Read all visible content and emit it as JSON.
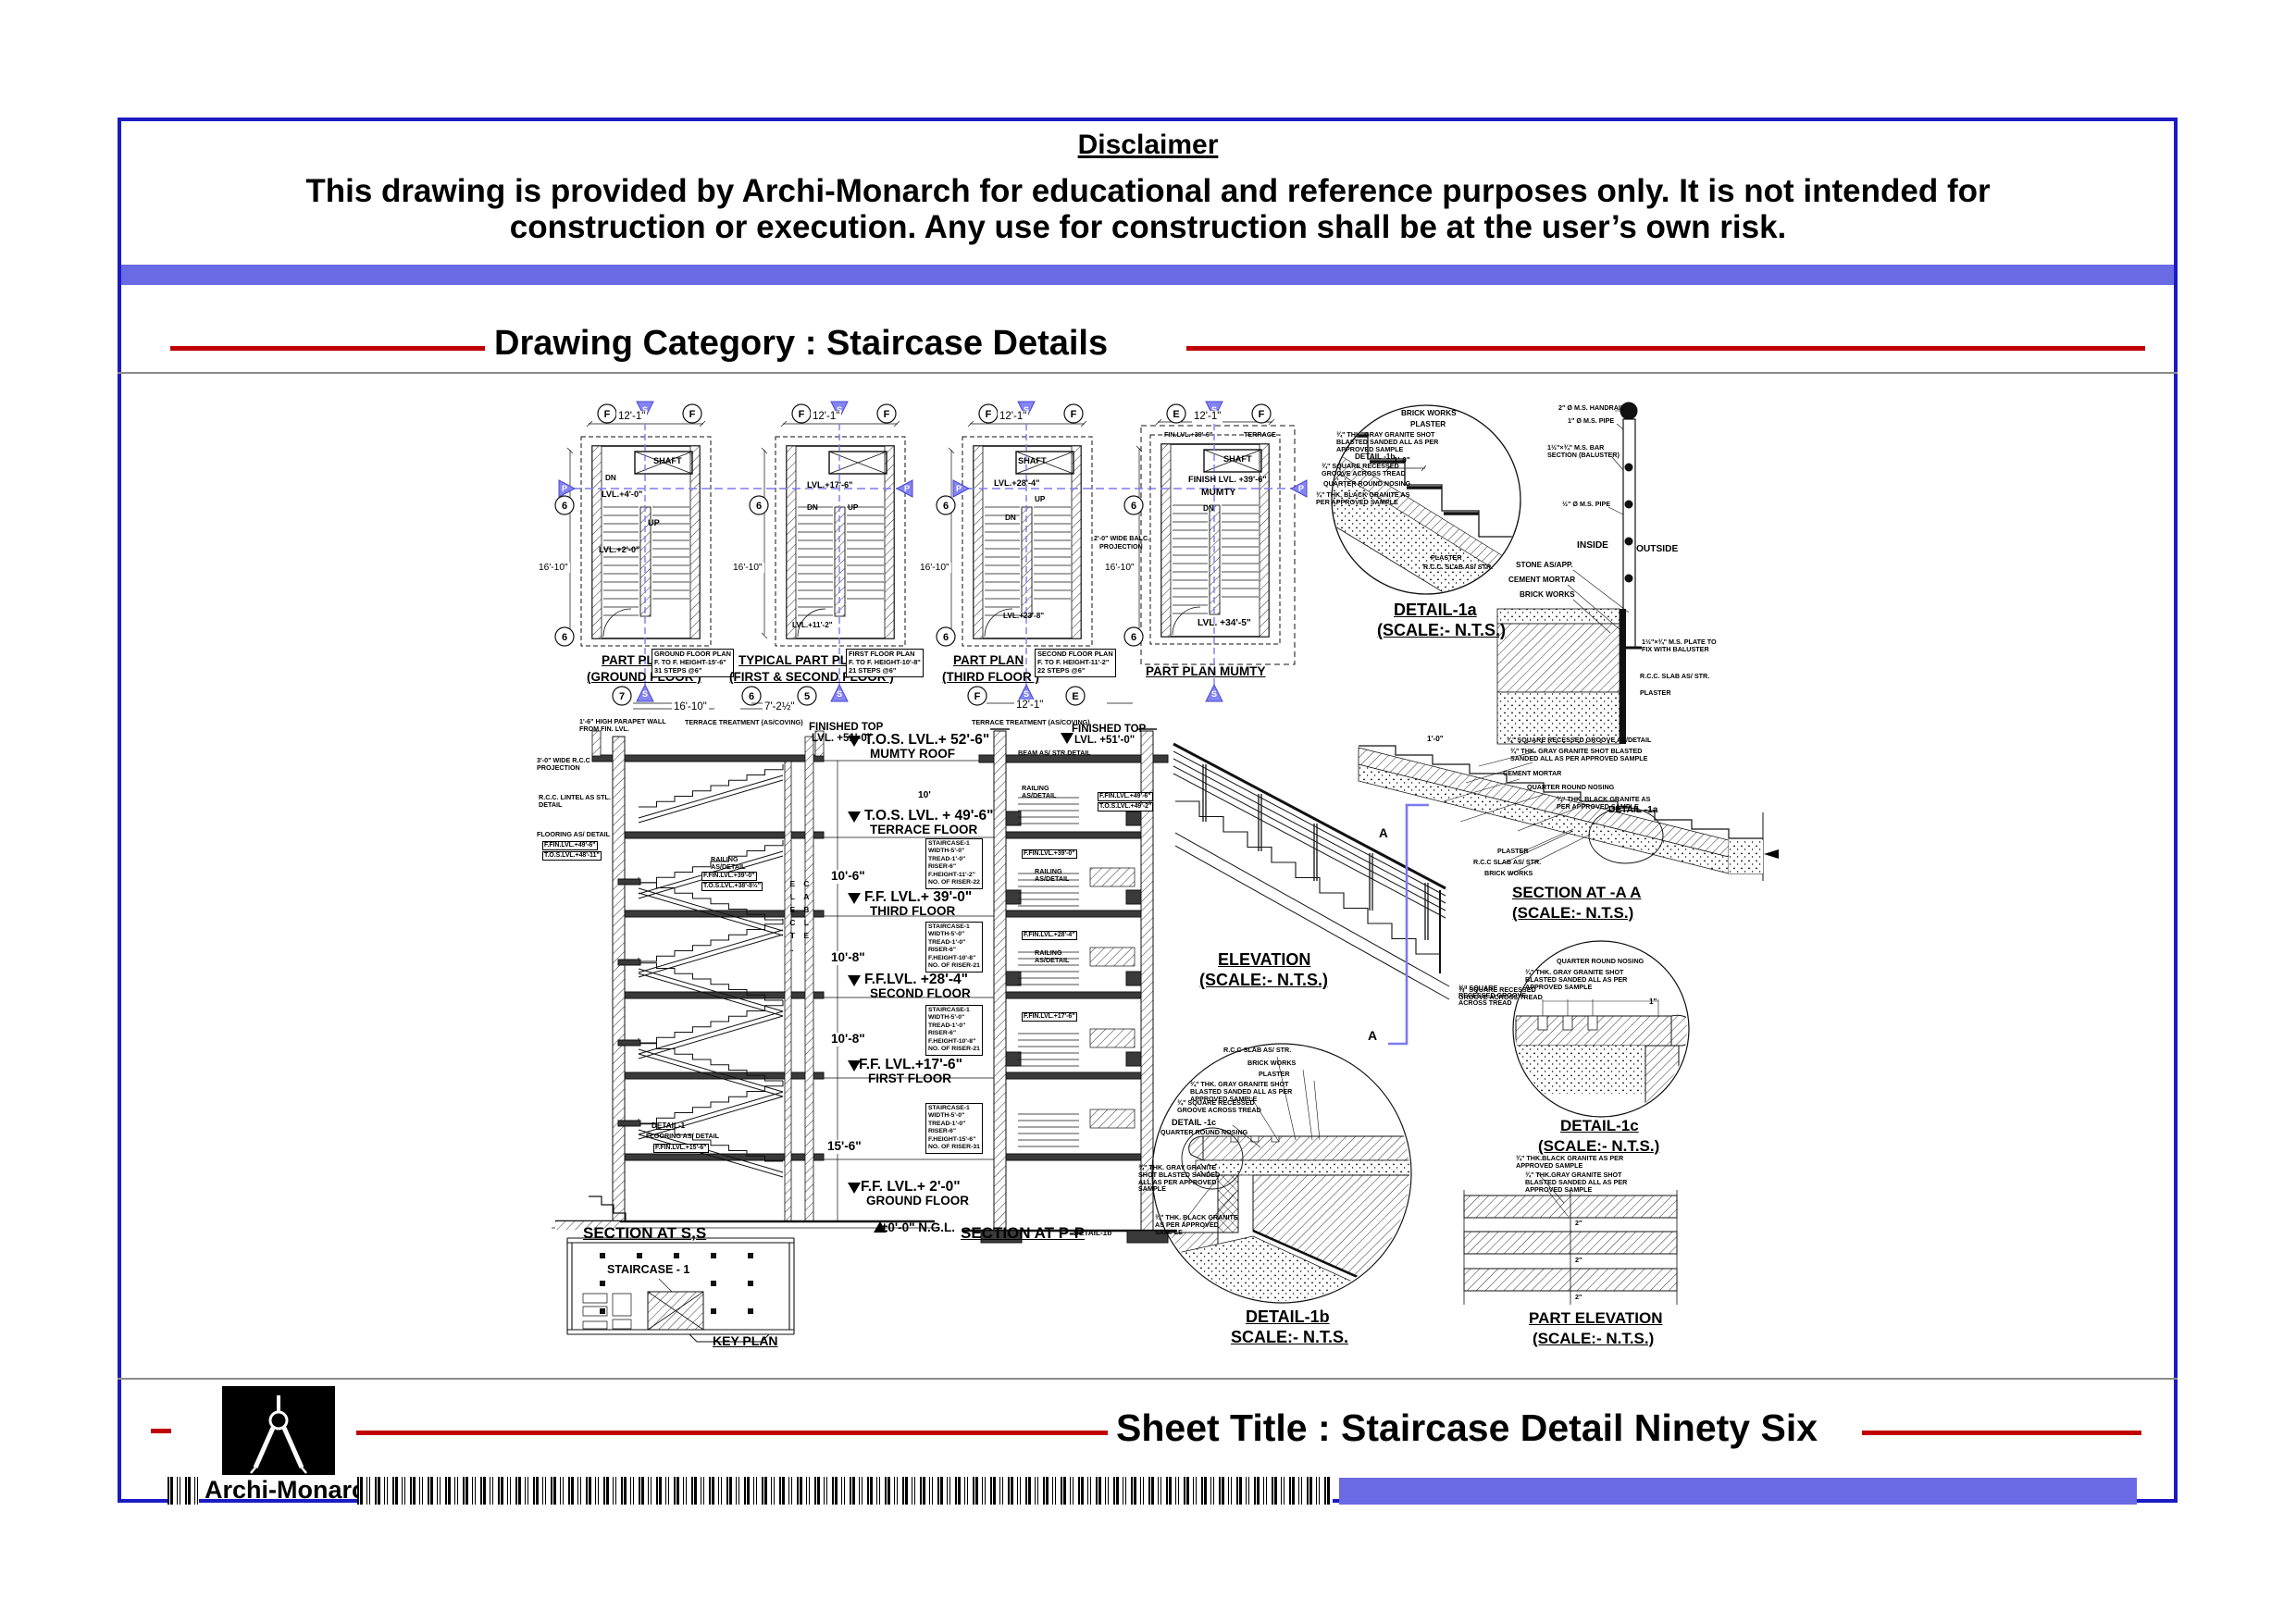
{
  "disclaimer": {
    "title": "Disclaimer",
    "line1": "This drawing is provided by Archi-Monarch for educational and reference purposes only. It is not intended for",
    "line2": "construction or execution. Any use for construction shall be at the user’s own risk."
  },
  "category": {
    "label": "Drawing Category : Staircase Details"
  },
  "footer": {
    "sheet_title": "Sheet Title : Staircase Detail Ninety Six",
    "brand": "Archi-Monarch"
  },
  "colors": {
    "frame_blue": "#1b1bc4",
    "band_blue": "#6a6ae4",
    "accent_red": "#c00000",
    "marker_blue": "#7b7bf0"
  },
  "plans": [
    {
      "title1": "PART PLAN",
      "title2": "(GROUND FLOOR )",
      "dim_w": "12'-1\"",
      "dim_h": "16'-10\"",
      "note1": "GROUND FLOOR PLAN",
      "note2": "F. TO F. HEIGHT-15'-6\"",
      "note3": "31 STEPS @6\"",
      "shaft": "SHAFT",
      "dn": "DN",
      "up": "UP",
      "lvl_a": "LVL.+4'-0\"",
      "lvl_b": "LVL.+2'-0\"",
      "b_t1": "F",
      "b_t2": "F",
      "b_s1": "6",
      "b_s2": "6",
      "b_b1": "7",
      "marker_s": "S",
      "marker_p": "P"
    },
    {
      "title1": "TYPICAL PART PLAN",
      "title2": "(FIRST & SECOND FLOOR )",
      "dim_w": "12'-1\"",
      "dim_h": "16'-10\"",
      "note1": "FIRST FLOOR PLAN",
      "note2": "F. TO F. HEIGHT-10'-8\"",
      "note3": "21 STEPS @6\"",
      "dn": "DN",
      "up": "UP",
      "lvl_a": "LVL.+17'-6\"",
      "lvl_b": "LVL.+11'-2\"",
      "b_t1": "F",
      "b_t2": "F",
      "b_s1": "6",
      "b_b1": "6",
      "b_b2": "5",
      "marker_s": "S",
      "marker_p": "P"
    },
    {
      "title1": "PART PLAN",
      "title2": "(THIRD  FLOOR )",
      "dim_w": "12'-1\"",
      "dim_h": "16'-10\"",
      "note1": "SECOND FLOOR PLAN",
      "note2": "F. TO F. HEIGHT-11'-2\"",
      "note3": "22 STEPS @6\"",
      "shaft": "SHAFT",
      "dn": "DN",
      "up": "UP",
      "lvl_a": "LVL.+28'-4\"",
      "lvl_b": "LVL.+23'-8\"",
      "b_t1": "F",
      "b_t2": "F",
      "b_s1": "6",
      "b_s2": "6",
      "b_b1": "F",
      "b_b2": "E",
      "marker_s": "S",
      "marker_p": "P"
    },
    {
      "title1": "PART PLAN MUMTY",
      "dim_w": "12'-1\"",
      "dim_h": "16'-10\"",
      "terrace": "TERRACE",
      "fin_top": "FIN.LVL.+39'-6\"",
      "shaft": "SHAFT",
      "finish": "FINISH LVL. +39'-6\"",
      "mumty": "MUMTY",
      "dn": "DN",
      "balc1": "2'-0\" WIDE BALC.",
      "balc2": "PROJECTION",
      "lvl_a": "LVL. +34'-5\"",
      "b_t1": "E",
      "b_t2": "F",
      "b_s1": "6",
      "b_s2": "6",
      "marker_s": "S",
      "marker_p": "P"
    }
  ],
  "detail_1a": {
    "title": "DETAIL-1a",
    "scale": "(SCALE:- N.T.S.)",
    "brick": "BRICK WORKS",
    "plaster": "PLASTER",
    "gray": "¾\" THK. GRAY GRANITE SHOT BLASTED SANDED ALL AS PER APPROVED SAMPLE",
    "callout": "DETAIL -1b",
    "square": "¾\" SQUARE RECESSED GROOVE ACROSS TREAD",
    "nosing": "QUARTER ROUND NOSING",
    "black": "¾\" THK. BLACK GRANITE AS PER APPROVED SAMPLE",
    "dim": "1'-0\"",
    "plaster2": "PLASTER",
    "rcc": "R.C.C. SLAB AS/ STR."
  },
  "baluster": {
    "handrail": "2\" Ø M.S. HANDRAIL",
    "pipe1": "1\" Ø M.S. PIPE",
    "bar": "1½\"×¾\" M.S. BAR SECTION (BALUSTER)",
    "pipe2": "½\" Ø M.S. PIPE",
    "inside": "INSIDE",
    "outside": "OUTSIDE",
    "stone": "STONE AS/APP.",
    "cement": "CEMENT MORTAR",
    "brick": "BRICK WORKS",
    "plate": "1½\"×¾\" M.S. PLATE TO FIX WITH BALUSTER",
    "rcc": "R.C.C. SLAB AS/ STR.",
    "plaster": "PLASTER"
  },
  "section_ss": {
    "title": "SECTION AT S,S",
    "dim1": "16'-10\"",
    "dim2": "7'-2½\"",
    "parapet": "1'-6\" HIGH PARAPET WALL FROM FIN. LVL.",
    "treat": "TERRACE TREATMENT (AS/COVING)",
    "proj": "3'-0\" WIDE R.C.C PROJECTION",
    "lintel": "R.C.C. LINTEL AS STL. DETAIL",
    "floor_note": "FLOORING AS/ DETAIL",
    "ffin49": "F.FIN.LVL.+49'-6\"",
    "tos48": "T.O.S.LVL.+48'-11\"",
    "rail": "RAILING AS/DETAIL",
    "ffin39": "F.FIN.LVL.+39'-0\"",
    "tos38": "T.O.S.LVL.+38'-8½\"",
    "detail1": "DETAIL-1",
    "ffin15": "F.FIN.LVL.+15'-6\""
  },
  "levels": {
    "fin_top1": "FINISHED TOP",
    "fin_top2": "LVL. +51'-0\"",
    "rows": [
      {
        "lvl": "T.O.S. LVL.+ 52'-6\"",
        "name": "MUMTY ROOF"
      },
      {
        "lvl": "T.O.S. LVL. + 49'-6\"",
        "name": "TERRACE FLOOR"
      },
      {
        "lvl": "F.F. LVL.+ 39'-0\"",
        "name": "THIRD FLOOR"
      },
      {
        "lvl": "F.F.LVL. +28'-4\"",
        "name": "SECOND FLOOR"
      },
      {
        "lvl": "F.F. LVL.+17'-6\"",
        "name": "FIRST FLOOR"
      },
      {
        "lvl": "F.F. LVL.+ 2'-0\"",
        "name": "GROUND FLOOR"
      }
    ],
    "ngl": "±0'-0\" N.G.L.",
    "d1": "10'-6\"",
    "d2": "10'-8\"",
    "d3": "10'-8\"",
    "d4": "15'-6\"",
    "d5": "10'"
  },
  "spec_boxes": [
    {
      "l1": "STAIRCASE-1",
      "l2": "WIDTH-5'-0\"",
      "l3": "TREAD-1'-0\"",
      "l4": "RISER-6\"",
      "l5": "F.HEIGHT-11'-2\"",
      "l6": "NO. OF RISER-22"
    },
    {
      "l1": "STAIRCASE-1",
      "l2": "WIDTH-5'-0\"",
      "l3": "TREAD-1'-0\"",
      "l4": "RISER-6\"",
      "l5": "F.HEIGHT-10'-8\"",
      "l6": "NO. OF RISER-21"
    },
    {
      "l1": "STAIRCASE-1",
      "l2": "WIDTH-5'-0\"",
      "l3": "TREAD-1'-0\"",
      "l4": "RISER-6\"",
      "l5": "F.HEIGHT-10'-8\"",
      "l6": "NO. OF RISER-21"
    },
    {
      "l1": "STAIRCASE-1",
      "l2": "WIDTH-5'-0\"",
      "l3": "TREAD-1'-0\"",
      "l4": "RISER-6\"",
      "l5": "F.HEIGHT-15'-6\"",
      "l6": "NO. OF RISER-31"
    }
  ],
  "section_pp": {
    "title": "SECTION AT P-P",
    "dim": "12'-1\"",
    "treat": "TERRACE TREATMENT (AS/COVING)",
    "fin_top1": "FINISHED TOP",
    "fin_top2": "LVL. +51'-0\"",
    "beam": "BEAM AS/ STR.DETAIL",
    "rail": "RAILING AS/DETAIL",
    "ffin49": "F.FIN.LVL.+49'-6\"",
    "tos49": "T.O.S.LVL.+49'-2\"",
    "ffin39": "F.FIN.LVL.+39'-0\"",
    "ffin28": "F.FIN.LVL.+28'-4\"",
    "ffin17": "F.FIN.LVL.+17'-6\"",
    "callout": "DETAIL-1b",
    "shaft1": "ELECT.",
    "shaft2": "CABLE"
  },
  "elevation": {
    "title": "ELEVATION",
    "scale": "(SCALE:- N.T.S.)",
    "a_top": "A",
    "a_bot": "A",
    "groove": "¾\" SQUARE RECESSED GROOVE ACROSS TREAD"
  },
  "section_aa": {
    "title": "SECTION AT -A A",
    "scale": "(SCALE:- N.T.S.)",
    "square": "¾\" SQUARE RECESSED GROOVE AS/DETAIL",
    "gray": "¾\" THK. GRAY GRANITE SHOT BLASTED SANDED ALL AS PER APPROVED SAMPLE",
    "cement": "CEMENT MORTAR",
    "nosing": "QUARTER ROUND NOSING",
    "black": "¾\" THK. BLACK GRANITE AS PER APPROVED SAMPLE",
    "plaster": "PLASTER",
    "rcc": "R.C.C SLAB AS/ STR.",
    "brick": "BRICK WORKS",
    "callout": "DETAIL -1a",
    "dim": "1'-0\""
  },
  "detail_1c": {
    "title": "DETAIL-1c",
    "scale": "(SCALE:- N.T.S.)",
    "nosing": "QUARTER ROUND NOSING",
    "gray": "¾\" THK. GRAY GRANITE SHOT BLASTED SANDED ALL AS PER APPROVED SAMPLE",
    "square": "¾\" SQUARE RECESSED GROOVE ACROSS TREAD",
    "dim": "1\""
  },
  "detail_1b": {
    "title": "DETAIL-1b",
    "scale": "SCALE:- N.T.S.",
    "rcc": "R.C.C SLAB AS/ STR.",
    "brick": "BRICK WORKS",
    "plaster": "PLASTER",
    "gray1": "¾\" THK. GRAY GRANITE SHOT BLASTED SANDED ALL AS PER APPROVED SAMPLE",
    "square": "¾\" SQUARE RECESSED GROOVE ACROSS TREAD",
    "callout": "DETAIL -1c",
    "nosing": "QUARTER ROUND NOSING",
    "gray2": "¾\" THK. GRAY GRANITE SHOT BLASTED SANDED ALL AS PER APPROVED SAMPLE",
    "black": "¾\" THK. BLACK GRANITE AS PER APPROVED SAMPLE"
  },
  "part_elevation": {
    "title": "PART ELEVATION",
    "scale": "(SCALE:- N.T.S.)",
    "black": "¾\" THK.BLACK GRANITE AS PER APPROVED SAMPLE",
    "gray": "¾\" THK.GRAY GRANITE SHOT BLASTED SANDED ALL AS PER APPROVED SAMPLE",
    "dim": "2\""
  },
  "key_plan": {
    "title": "KEY PLAN",
    "label": "STAIRCASE - 1"
  }
}
